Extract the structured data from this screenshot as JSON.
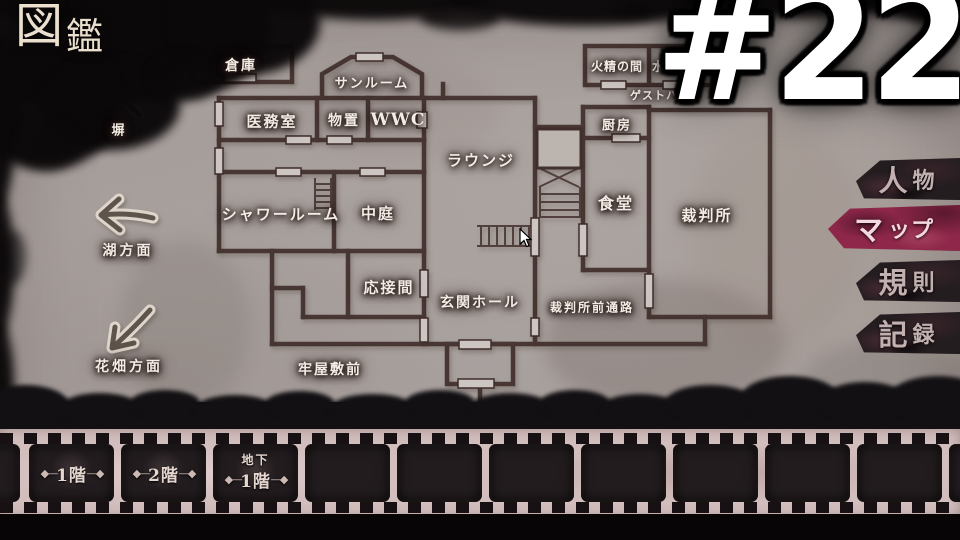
{
  "header": {
    "title_c1": "図",
    "title_c2": "鑑"
  },
  "overlay": {
    "episode_number": "#22"
  },
  "side_tabs": {
    "active_color": "#8e2749",
    "items": [
      {
        "id": "people",
        "l1": "人",
        "l2": "物",
        "active": false
      },
      {
        "id": "map",
        "l1": "マ",
        "l2": "ップ",
        "active": true
      },
      {
        "id": "rules",
        "l1": "規",
        "l2": "則",
        "active": false
      },
      {
        "id": "records",
        "l1": "記",
        "l2": "録",
        "active": false
      }
    ]
  },
  "map": {
    "rooms": [
      {
        "label": "倉庫"
      },
      {
        "label": "サンルーム"
      },
      {
        "label": "医務室"
      },
      {
        "label": "物置"
      },
      {
        "label": "WWC"
      },
      {
        "label": "ラウンジ"
      },
      {
        "label": "シャワールーム"
      },
      {
        "label": "中庭"
      },
      {
        "label": "応接間"
      },
      {
        "label": "玄関ホール"
      },
      {
        "label": "厨房"
      },
      {
        "label": "食堂"
      },
      {
        "label": "裁判所"
      },
      {
        "label": "裁判所前通路"
      },
      {
        "label": "火精の間"
      },
      {
        "label": "水精の間"
      },
      {
        "label": "ゲストハウス"
      },
      {
        "label": "牢屋敷前"
      }
    ],
    "outdoor_labels": [
      {
        "label": "塀"
      },
      {
        "label": "湖方面"
      },
      {
        "label": "花畑方面"
      }
    ]
  },
  "floor_strip": {
    "ornament_left": "◆―",
    "ornament_right": "―◆",
    "floors": [
      {
        "id": "floor-1f",
        "sub": "",
        "label": "1階"
      },
      {
        "id": "floor-2f",
        "sub": "",
        "label": "2階"
      },
      {
        "id": "floor-b1",
        "sub": "地下",
        "label": "1階"
      }
    ]
  },
  "colors": {
    "paper": "#a8a09d",
    "wall": "#3f2d2a",
    "film_base": "#d3bebe",
    "active_tab": "#8e2749"
  }
}
